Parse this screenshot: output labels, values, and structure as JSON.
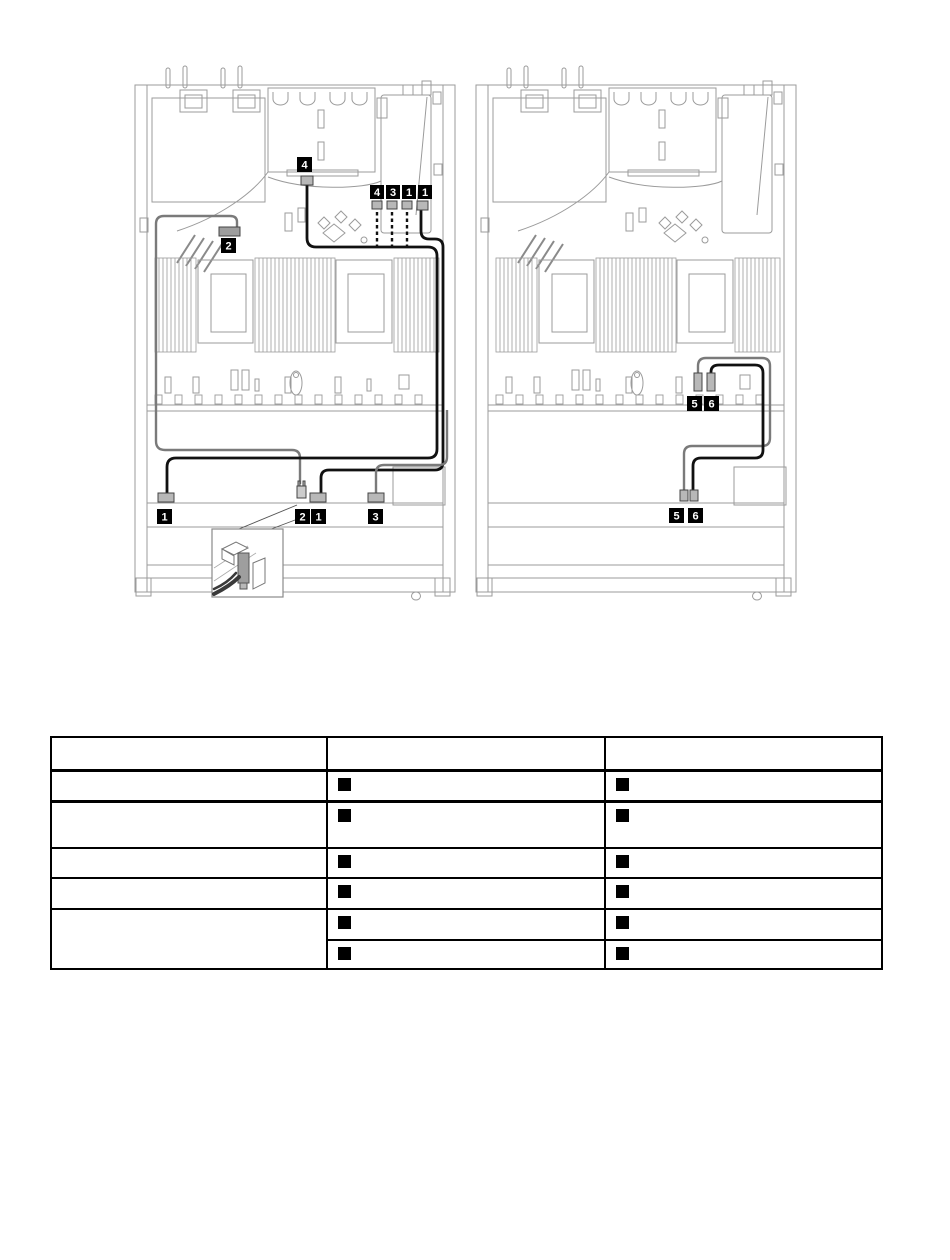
{
  "page": {
    "background": "#ffffff"
  },
  "colors": {
    "line_art": "#9b9b9b",
    "line_art_dark": "#7d7d7d",
    "cable_black": "#111111",
    "cable_gray": "#7a7a7a",
    "connector_fill": "#b8b8b8",
    "badge_bg": "#000000",
    "badge_fg": "#ffffff",
    "table_border": "#000000",
    "marker": "#000000"
  },
  "diagram_left": {
    "name": "server-top-view-cable-routing-left",
    "fan_connector_callout": "4",
    "front_connector_callout": "2",
    "board_callouts": [
      "4",
      "3",
      "1",
      "1"
    ],
    "backplane_callouts": [
      "1",
      "2",
      "1",
      "3"
    ],
    "has_connector_detail_inset": true
  },
  "diagram_right": {
    "name": "server-top-view-cable-routing-right",
    "board_callouts": [
      "5",
      "6"
    ],
    "backplane_callouts": [
      "5",
      "6"
    ]
  },
  "table": {
    "header": [
      "",
      "",
      ""
    ],
    "body": [
      {
        "label": "",
        "markers": [
          true,
          true
        ]
      },
      {
        "label": "",
        "markers": [
          true,
          true
        ]
      },
      {
        "label": "",
        "markers": [
          true,
          true
        ]
      },
      {
        "label": "",
        "markers": [
          true,
          true
        ]
      },
      {
        "label": "",
        "sub": [
          {
            "markers": [
              true,
              true
            ]
          },
          {
            "markers": [
              true,
              true
            ]
          }
        ]
      }
    ]
  }
}
